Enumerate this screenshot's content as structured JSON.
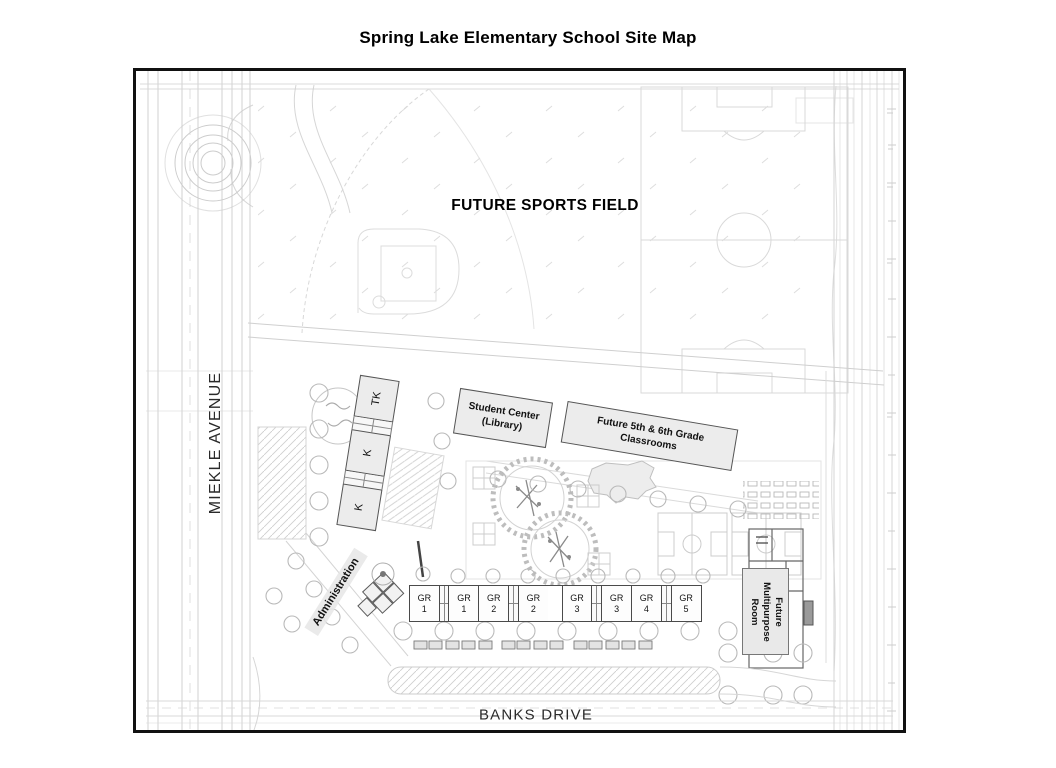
{
  "page": {
    "title": "Spring Lake Elementary School Site Map"
  },
  "map": {
    "streets": {
      "west": "MIEKLE AVENUE",
      "south": "BANKS DRIVE"
    },
    "labels": {
      "sports_field": "FUTURE SPORTS FIELD"
    },
    "buildings": {
      "tk": "TK",
      "k_upper": "K",
      "k_lower": "K",
      "administration": "Administration",
      "student_center": {
        "line1": "Student Center",
        "line2": "(Library)"
      },
      "future_classrooms": {
        "line1": "Future 5th & 6th Grade",
        "line2": "Classrooms"
      },
      "multipurpose": "Future Multipurpose Room"
    },
    "gr_rooms": [
      {
        "abbr": "GR",
        "num": "1"
      },
      {
        "abbr": "GR",
        "num": "1"
      },
      {
        "abbr": "GR",
        "num": "2"
      },
      {
        "abbr": "GR",
        "num": "2"
      },
      {
        "abbr": "GR",
        "num": "3"
      },
      {
        "abbr": "GR",
        "num": "3"
      },
      {
        "abbr": "GR",
        "num": "4"
      },
      {
        "abbr": "GR",
        "num": "5"
      }
    ]
  },
  "colors": {
    "map_border": "#111111",
    "building_fill": "#ececec",
    "building_border": "#555555",
    "linework_faint": "#d6d6d6",
    "text": "#111111"
  }
}
